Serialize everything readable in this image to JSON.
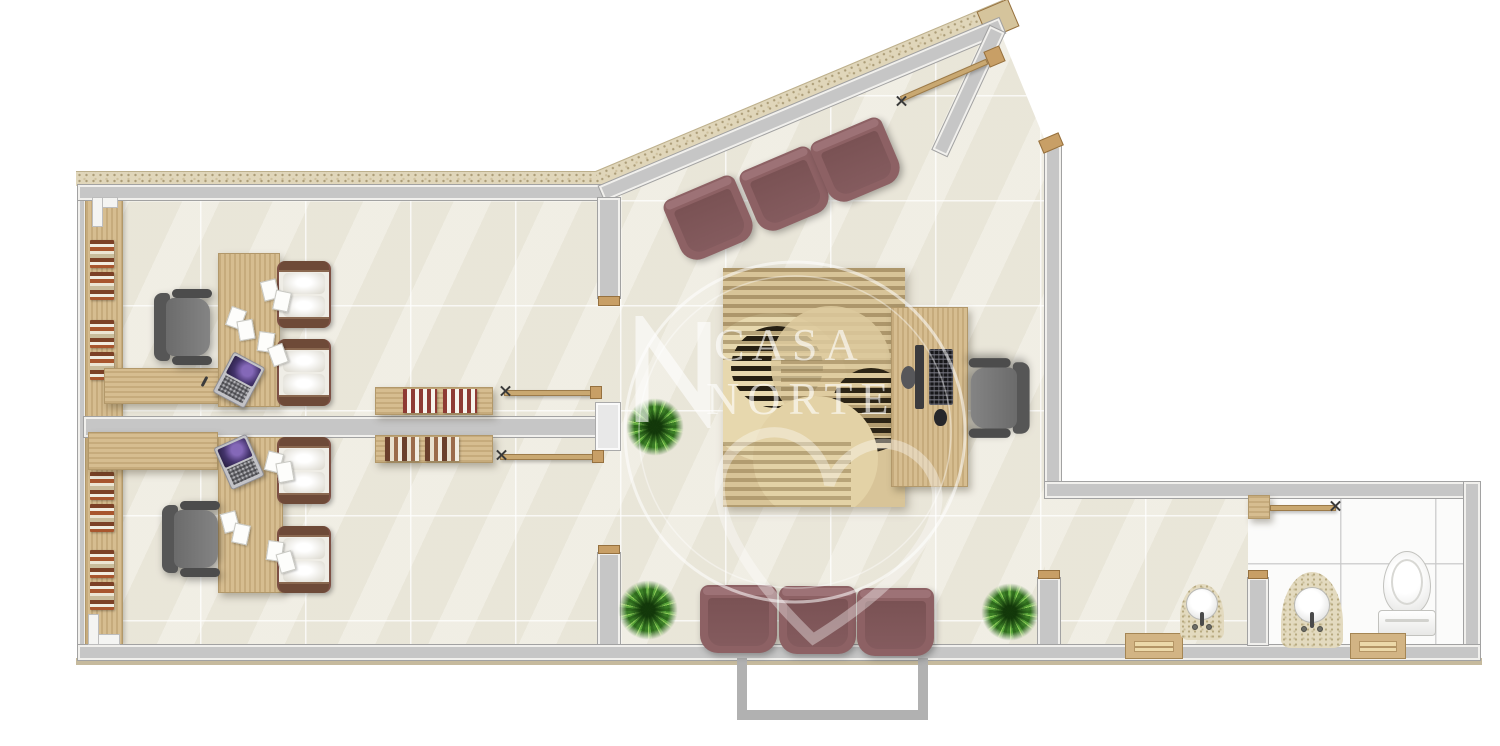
{
  "watermark": {
    "brand_line1": "CASA",
    "brand_line2": "NORTE"
  },
  "palette": {
    "wall_gray": "#c6c6c6",
    "wall_edge": "#a2a2a2",
    "floor_beige": "#edeade",
    "floor_white": "#fbfbfa",
    "wood": "#d6bd90",
    "wood_trim": "#c89f66",
    "stone_speckle": "#e0d6ba",
    "rug_base": "#d8c498",
    "rug_dark": "#261f12",
    "armchair_maroon": "#8d6164",
    "office_chair_gray": "#6b6b6b",
    "recliner_frame_brown": "#6e4a38",
    "plant_green": "#55a238",
    "watermark_white": "rgba(255,255,255,0.62)"
  },
  "inventory": {
    "treatment_rooms": 2,
    "waiting_armchairs_top": 3,
    "waiting_armchairs_bottom": 3,
    "recliner_chairs": 4,
    "office_chairs": 3,
    "desks": 3,
    "laptops": 2,
    "computer_workstations": 1,
    "bookshelf_units": 2,
    "plants": 3,
    "washbasins": 2,
    "toilets": 1,
    "vanity_cabinets": 2,
    "hanging_rails": 4
  }
}
